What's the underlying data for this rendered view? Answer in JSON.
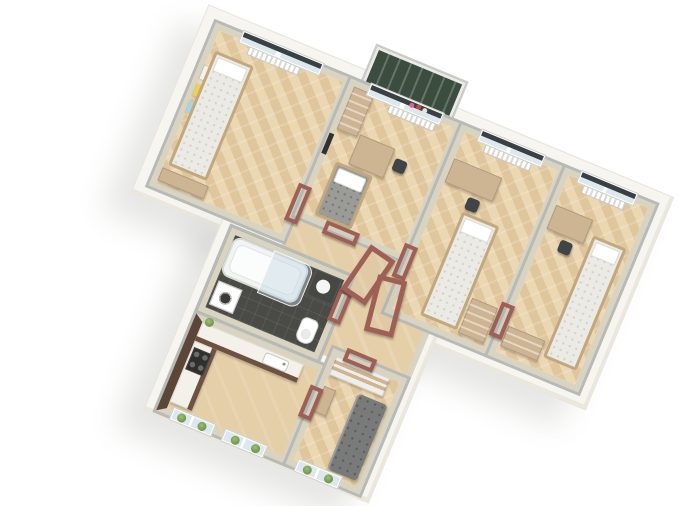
{
  "scene": {
    "description": "Photoreal 3D isometric top-down render of a T-shaped apartment floor plan on a plain white background, plan rotated clockwise",
    "view": "axonometric top-down",
    "rotation_deg": 22.5,
    "background": "#ffffff",
    "visible_text": "none"
  },
  "palette": {
    "background": "#ffffff",
    "exterior-slab": "#f6f5f0",
    "wall-face": "#d9d4c1",
    "wall-top": "#b7bab6",
    "floor-light": "#ecd7b3",
    "floor-dark": "#e0c69d",
    "hall-floor": "#e5cfa9",
    "door-frame": "#9e6055",
    "balcony-floor": "#3a4d3f",
    "blind": "#3a4145",
    "glass": "#dce8ee",
    "bed-quilt": "#eceae4",
    "bed-frame-wood": "#c2a87f",
    "gray-bed": "#9b9b97",
    "desk-wood": "#cdb493",
    "chair-dark": "#3f4447",
    "kitchen-counter": "#f3f1ea",
    "kitchen-cabinet": "#6d5242",
    "kitchen-accent-wall": "#5c4638",
    "bathroom-floor": "#4a4a46",
    "sofa-gray": "#797b7a",
    "plant-green": "#6f924f",
    "radiator": "#ffffff"
  },
  "rooms": [
    {
      "id": "bedroom-1",
      "name": "Bedroom (top-left)",
      "floor": "herringbone parquet",
      "furniture": [
        "single bed with white quilt",
        "corner desk",
        "radiator under window",
        "window with dark roller blind",
        "colorful wall posters"
      ]
    },
    {
      "id": "bedroom-2",
      "name": "Bedroom with balcony (top-center-left)",
      "floor": "herringbone parquet",
      "furniture": [
        "gray quilted bed",
        "table",
        "dark chair",
        "tall cabinet",
        "radiator",
        "balcony door",
        "flowers on windowsill",
        "wall TV"
      ]
    },
    {
      "id": "bedroom-3",
      "name": "Bedroom (top-center-right)",
      "floor": "herringbone parquet",
      "furniture": [
        "single bed",
        "desk",
        "dark chair",
        "wardrobe",
        "radiator",
        "window with dark roller blind"
      ]
    },
    {
      "id": "bedroom-4",
      "name": "Bedroom (top-right)",
      "floor": "herringbone parquet",
      "furniture": [
        "single bed along right wall",
        "desk",
        "dark chair",
        "dresser",
        "radiator",
        "window with dark roller blind"
      ]
    },
    {
      "id": "bathroom",
      "name": "Bathroom (middle-left)",
      "floor": "dark tile",
      "furniture": [
        "bathtub with curved glass screen",
        "washing machine",
        "toilet",
        "dark vanity counter with sink"
      ]
    },
    {
      "id": "kitchen",
      "name": "Kitchen (bottom-left)",
      "floor": "parquet",
      "furniture": [
        "L-shaped counter with white top and brown cabinets",
        "stove with four burners",
        "sink",
        "dark brown accent wall",
        "two windows with plants on sills"
      ]
    },
    {
      "id": "bedroom-5",
      "name": "Small bedroom (bottom-center)",
      "floor": "chevron parquet",
      "furniture": [
        "gray sofa bed",
        "white-and-wood wardrobe",
        "vanity table",
        "window with plants on sill"
      ]
    },
    {
      "id": "hallway",
      "name": "Hallway (center)",
      "floor": "plain parquet",
      "furniture": [
        "several terracotta wooden door frames, two standing loose"
      ]
    }
  ],
  "balcony": {
    "attached_to": "bedroom-2",
    "floor": "dark green with white railing frame"
  }
}
